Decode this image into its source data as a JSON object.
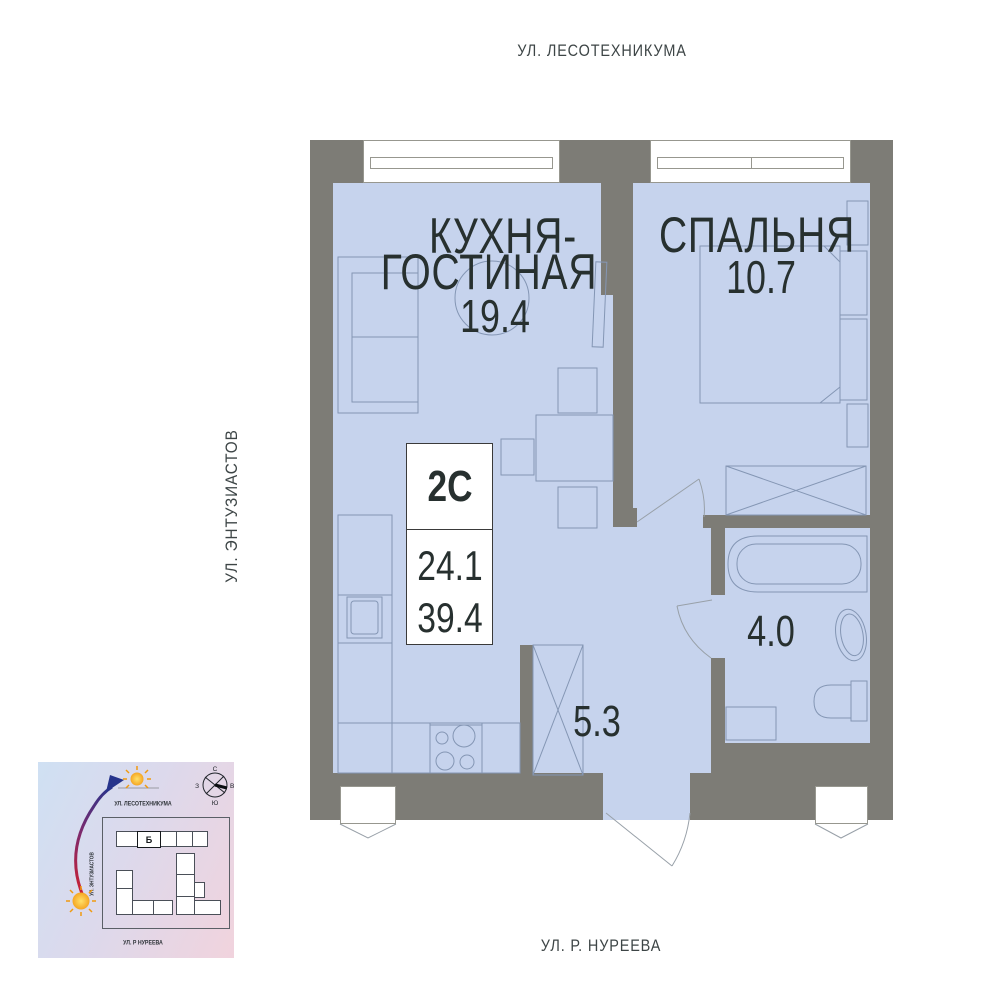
{
  "streets": {
    "top": "УЛ. ЛЕСОТЕХНИКУМА",
    "left": "УЛ. ЭНТУЗИАСТОВ",
    "bottom": "УЛ. Р. НУРЕЕВА"
  },
  "plan": {
    "rooms": [
      {
        "id": "kitchen-living",
        "line1": "КУХНЯ-",
        "line2": "ГОСТИНАЯ",
        "area": "19.4"
      },
      {
        "id": "bedroom",
        "name": "СПАЛЬНЯ",
        "area": "10.7"
      },
      {
        "id": "bathroom",
        "area": "4.0"
      },
      {
        "id": "hallway",
        "area": "5.3"
      }
    ],
    "info_box": {
      "type_label": "2С",
      "living_area": "24.1",
      "total_area": "39.4"
    }
  },
  "minimap": {
    "street_top": "УЛ. ЛЕСОТЕХНИКУМА",
    "street_left": "УЛ. ЭНТУЗИАСТОВ",
    "street_bottom": "УЛ. Р НУРЕЕВА",
    "building_label": "Б",
    "compass": {
      "n": "С",
      "e": "В",
      "s": "Ю",
      "w": "З"
    }
  },
  "colors": {
    "room_fill": "#c6d3ed",
    "wall": "#7d7c76",
    "furniture_line": "#8496b4",
    "door_line": "#98a0a8",
    "text_dark": "#27302f",
    "street_text": "#3d4546",
    "window_frame": "#97978f"
  }
}
